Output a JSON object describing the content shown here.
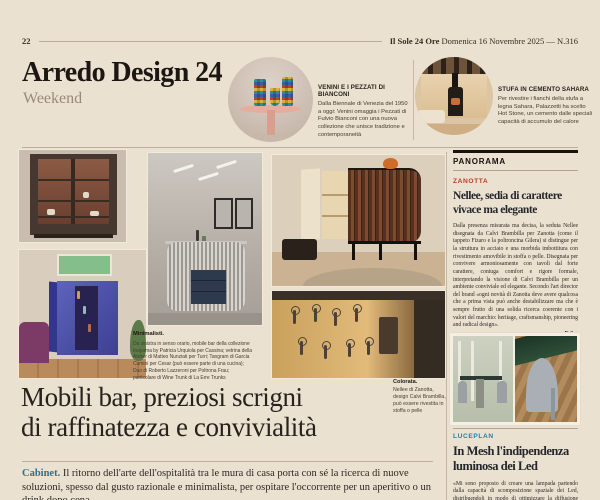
{
  "masthead": {
    "page_number": "22",
    "paper_name": "Il Sole 24 Ore",
    "issue_info": "Domenica 16 Novembre 2025 — N.316"
  },
  "section": {
    "title": "Arredo Design 24",
    "subtitle": "Weekend"
  },
  "briefs": [
    {
      "title": "VENINI E I PEZZATI DI BIANCONI",
      "text": "Dalla Biennale di Venezia del 1950 a oggi: Venini omaggia i Pezzati di Fulvio Bianconi con una nuova collezione che unisce tradizione e contemporaneità"
    },
    {
      "title": "STUFA IN CEMENTO SAHARA",
      "text": "Per rivestire i fianchi della stufa a legna Sahara, Palazzetti ha scelto Hot Stone, un cemento dalle speciali capacità di accumulo del calore"
    }
  ],
  "article": {
    "caption_label": "Minimalisti.",
    "caption_text": "Da sinistra in senso orario, mobile bar della collezione Inayama by Patricia Urquiola per Cassina; vetrina della Atelier di Matteo Nunziati per Turri; Tangram di Garcia Cumini per Cesar (può essere parte di una cucina); Duo di Roberto Lazzeroni per Poltrona Frau; particolare di Wine Trunk di La Erre Trunks",
    "headline_line1": "Mobili bar, preziosi scrigni",
    "headline_line2": "di raffinatezza e convivialità",
    "standfirst_label": "Cabinet.",
    "standfirst_text": "Il ritorno dell'arte dell'ospitalità tra le mura di casa porta con sé la ricerca di nuove soluzioni, spesso dal gusto razionale e minimalista, per ospitare l'occorrente per un aperitivo o un drink dopo cena"
  },
  "side_caption": {
    "label": "Colorata.",
    "text": "Nellee di Zanotta, design Calvi Brambilla, può essere rivestita in stoffa o pelle"
  },
  "panorama": {
    "header": "PANORAMA",
    "zanotta": {
      "tag": "ZANOTTA",
      "headline_line1": "Nellee, sedia di carattere",
      "headline_line2": "vivace ma elegante",
      "body": "Dalla presenza misurata ma decisa, la seduta Nellee disegnata da Calvi Brambilla per Zanotta (come il tappeto Fizaro e la poltroncina Gilera) si distingue per la struttura in acciaio e una morbida imbottitura con rivestimento amovibile in stoffa o pelle. Disegnata per convivere armoniosamente con tavoli dal forte carattere, coniuga comfort e rigore formale, interpretando la visione di Calvi Brambilla per un ambiente conviviale ed elegante. Secondo l'art director del brand «ogni novità di Zanotta deve avere qualcosa che a prima vista può anche destabilizzare ma che è sempre frutto di una solida ricerca coerente con i valori del marchio: heritage, craftsmanship, pioneering and radical design».",
      "signature": "– E.Sg.",
      "copyright": "© RIPRODUZIONE RISERVATA"
    },
    "luceplan": {
      "tag": "LUCEPLAN",
      "headline_line1": "In Mesh l'indipendenza",
      "headline_line2": "luminosa dei Led",
      "body": "«Mi sono proposto di creare una lampada partendo dalla capacità di scomposizione spaziale dei Led, distribuendoli in modo di ottimizzare la diffusione della luce"
    }
  },
  "colors": {
    "accent_red": "#bf3a2b",
    "accent_blue": "#2e7ba6",
    "page_bg": "#ebe1d1"
  }
}
